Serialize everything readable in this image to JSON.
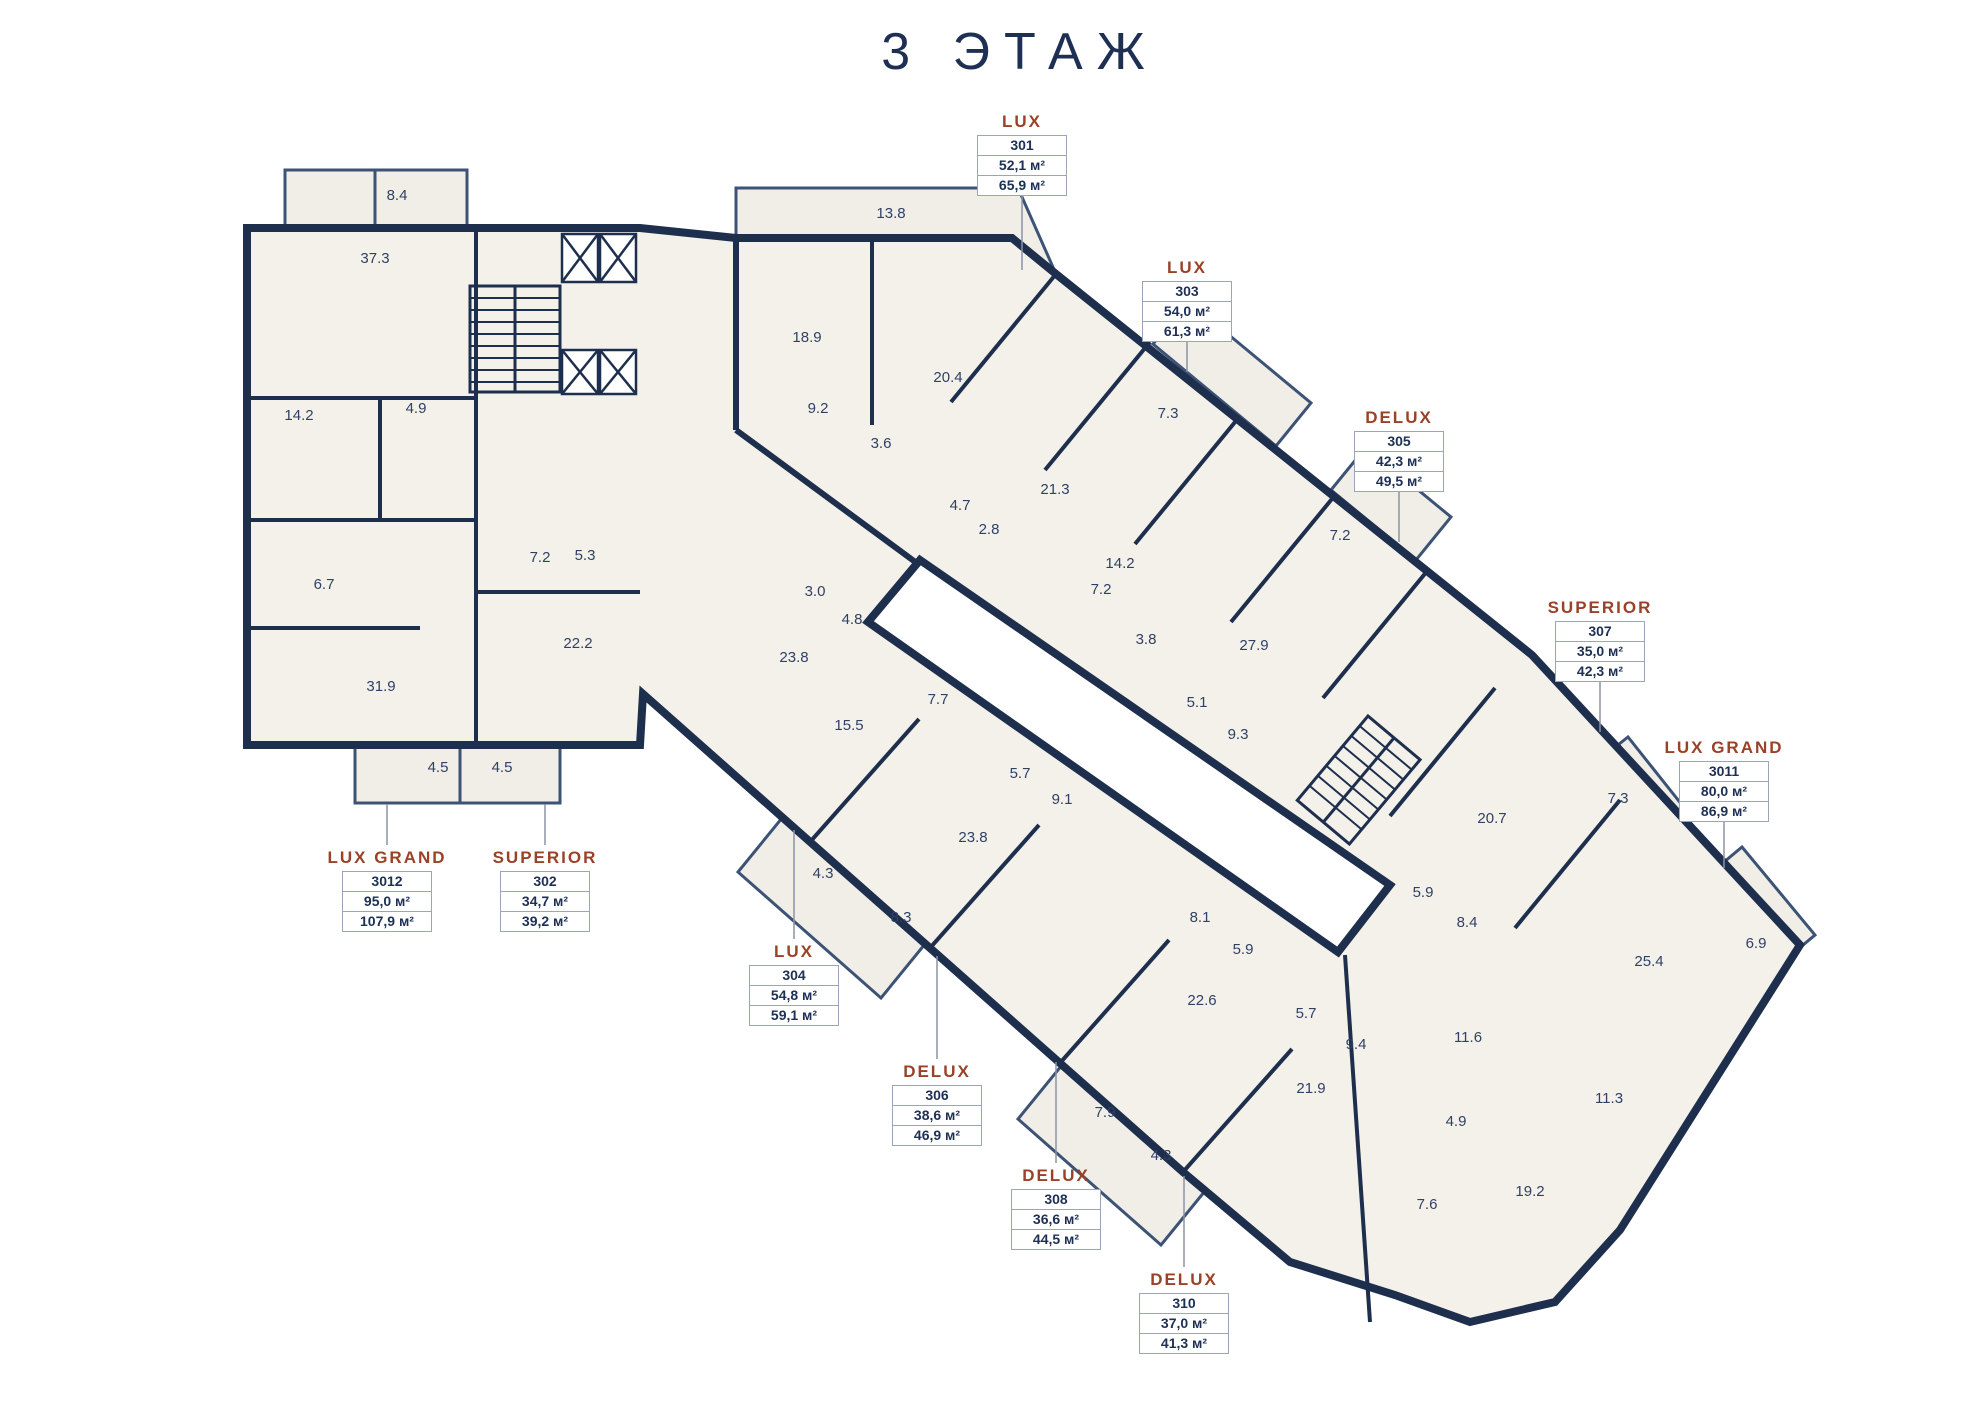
{
  "title": "3 ЭТАЖ",
  "colors": {
    "wall": "#1e2f4e",
    "room_fill": "#f4f1ea",
    "balcony_fill": "#f1eee7",
    "accent": "#9a4227",
    "navy_text": "#1d3054",
    "room_text": "#2f4165",
    "box_border": "#9aa6b8",
    "leader": "#8a93a6"
  },
  "area_unit": "м²",
  "apartments": [
    {
      "type": "LUX",
      "unit": "301",
      "area_living": "52,1 м²",
      "area_total": "65,9 м²",
      "cx": 1022,
      "top": 112,
      "leader": [
        1022,
        192,
        1022,
        270
      ]
    },
    {
      "type": "LUX",
      "unit": "303",
      "area_living": "54,0 м²",
      "area_total": "61,3 м²",
      "cx": 1187,
      "top": 258,
      "leader": [
        1187,
        338,
        1187,
        372
      ]
    },
    {
      "type": "DELUX",
      "unit": "305",
      "area_living": "42,3 м²",
      "area_total": "49,5 м²",
      "cx": 1399,
      "top": 408,
      "leader": [
        1399,
        488,
        1399,
        542
      ]
    },
    {
      "type": "SUPERIOR",
      "unit": "307",
      "area_living": "35,0 м²",
      "area_total": "42,3 м²",
      "cx": 1600,
      "top": 598,
      "leader": [
        1600,
        678,
        1600,
        732
      ]
    },
    {
      "type": "LUX GRAND",
      "unit": "3011",
      "area_living": "80,0 м²",
      "area_total": "86,9 м²",
      "cx": 1724,
      "top": 738,
      "leader": [
        1724,
        818,
        1724,
        868
      ]
    },
    {
      "type": "LUX GRAND",
      "unit": "3012",
      "area_living": "95,0 м²",
      "area_total": "107,9 м²",
      "cx": 387,
      "top": 848,
      "leader": [
        387,
        804,
        387,
        845
      ]
    },
    {
      "type": "SUPERIOR",
      "unit": "302",
      "area_living": "34,7 м²",
      "area_total": "39,2 м²",
      "cx": 545,
      "top": 848,
      "leader": [
        545,
        804,
        545,
        845
      ]
    },
    {
      "type": "LUX",
      "unit": "304",
      "area_living": "54,8 м²",
      "area_total": "59,1 м²",
      "cx": 794,
      "top": 942,
      "leader": [
        794,
        830,
        794,
        939
      ]
    },
    {
      "type": "DELUX",
      "unit": "306",
      "area_living": "38,6 м²",
      "area_total": "46,9 м²",
      "cx": 937,
      "top": 1062,
      "leader": [
        937,
        956,
        937,
        1059
      ]
    },
    {
      "type": "DELUX",
      "unit": "308",
      "area_living": "36,6 м²",
      "area_total": "44,5 м²",
      "cx": 1056,
      "top": 1166,
      "leader": [
        1056,
        1062,
        1056,
        1163
      ]
    },
    {
      "type": "DELUX",
      "unit": "310",
      "area_living": "37,0 м²",
      "area_total": "41,3 м²",
      "cx": 1184,
      "top": 1270,
      "leader": [
        1184,
        1176,
        1184,
        1267
      ]
    }
  ],
  "rooms": [
    {
      "a": "8.4",
      "x": 397,
      "y": 200
    },
    {
      "a": "37.3",
      "x": 375,
      "y": 263
    },
    {
      "a": "14.2",
      "x": 299,
      "y": 420
    },
    {
      "a": "4.9",
      "x": 416,
      "y": 413
    },
    {
      "a": "6.7",
      "x": 324,
      "y": 589
    },
    {
      "a": "31.9",
      "x": 381,
      "y": 691
    },
    {
      "a": "7.2",
      "x": 540,
      "y": 562
    },
    {
      "a": "5.3",
      "x": 585,
      "y": 560
    },
    {
      "a": "22.2",
      "x": 578,
      "y": 648
    },
    {
      "a": "4.5",
      "x": 438,
      "y": 772
    },
    {
      "a": "4.5",
      "x": 502,
      "y": 772
    },
    {
      "a": "13.8",
      "x": 891,
      "y": 218
    },
    {
      "a": "18.9",
      "x": 807,
      "y": 342
    },
    {
      "a": "20.4",
      "x": 948,
      "y": 382
    },
    {
      "a": "9.2",
      "x": 818,
      "y": 413
    },
    {
      "a": "3.6",
      "x": 881,
      "y": 448
    },
    {
      "a": "21.3",
      "x": 1055,
      "y": 494
    },
    {
      "a": "4.7",
      "x": 960,
      "y": 510
    },
    {
      "a": "2.8",
      "x": 989,
      "y": 534
    },
    {
      "a": "14.2",
      "x": 1120,
      "y": 568
    },
    {
      "a": "7.2",
      "x": 1101,
      "y": 594
    },
    {
      "a": "7.3",
      "x": 1168,
      "y": 418
    },
    {
      "a": "3.8",
      "x": 1146,
      "y": 644
    },
    {
      "a": "7.2",
      "x": 1340,
      "y": 540
    },
    {
      "a": "27.9",
      "x": 1254,
      "y": 650
    },
    {
      "a": "5.1",
      "x": 1197,
      "y": 707
    },
    {
      "a": "9.3",
      "x": 1238,
      "y": 739
    },
    {
      "a": "23.8",
      "x": 794,
      "y": 662
    },
    {
      "a": "3.0",
      "x": 815,
      "y": 596
    },
    {
      "a": "4.8",
      "x": 852,
      "y": 624
    },
    {
      "a": "7.7",
      "x": 938,
      "y": 704
    },
    {
      "a": "15.5",
      "x": 849,
      "y": 730
    },
    {
      "a": "5.7",
      "x": 1020,
      "y": 778
    },
    {
      "a": "9.1",
      "x": 1062,
      "y": 804
    },
    {
      "a": "23.8",
      "x": 973,
      "y": 842
    },
    {
      "a": "4.3",
      "x": 823,
      "y": 878
    },
    {
      "a": "8.3",
      "x": 901,
      "y": 922
    },
    {
      "a": "8.1",
      "x": 1200,
      "y": 922
    },
    {
      "a": "5.9",
      "x": 1243,
      "y": 954
    },
    {
      "a": "22.6",
      "x": 1202,
      "y": 1005
    },
    {
      "a": "5.7",
      "x": 1306,
      "y": 1018
    },
    {
      "a": "9.4",
      "x": 1356,
      "y": 1049
    },
    {
      "a": "21.9",
      "x": 1311,
      "y": 1093
    },
    {
      "a": "7.9",
      "x": 1105,
      "y": 1117
    },
    {
      "a": "4.3",
      "x": 1161,
      "y": 1160
    },
    {
      "a": "20.7",
      "x": 1492,
      "y": 823
    },
    {
      "a": "7.3",
      "x": 1618,
      "y": 803
    },
    {
      "a": "5.9",
      "x": 1423,
      "y": 897
    },
    {
      "a": "8.4",
      "x": 1467,
      "y": 927
    },
    {
      "a": "25.4",
      "x": 1649,
      "y": 966
    },
    {
      "a": "6.9",
      "x": 1756,
      "y": 948
    },
    {
      "a": "11.6",
      "x": 1468,
      "y": 1042
    },
    {
      "a": "4.9",
      "x": 1456,
      "y": 1126
    },
    {
      "a": "11.3",
      "x": 1609,
      "y": 1103
    },
    {
      "a": "7.6",
      "x": 1427,
      "y": 1209
    },
    {
      "a": "19.2",
      "x": 1530,
      "y": 1196
    }
  ]
}
